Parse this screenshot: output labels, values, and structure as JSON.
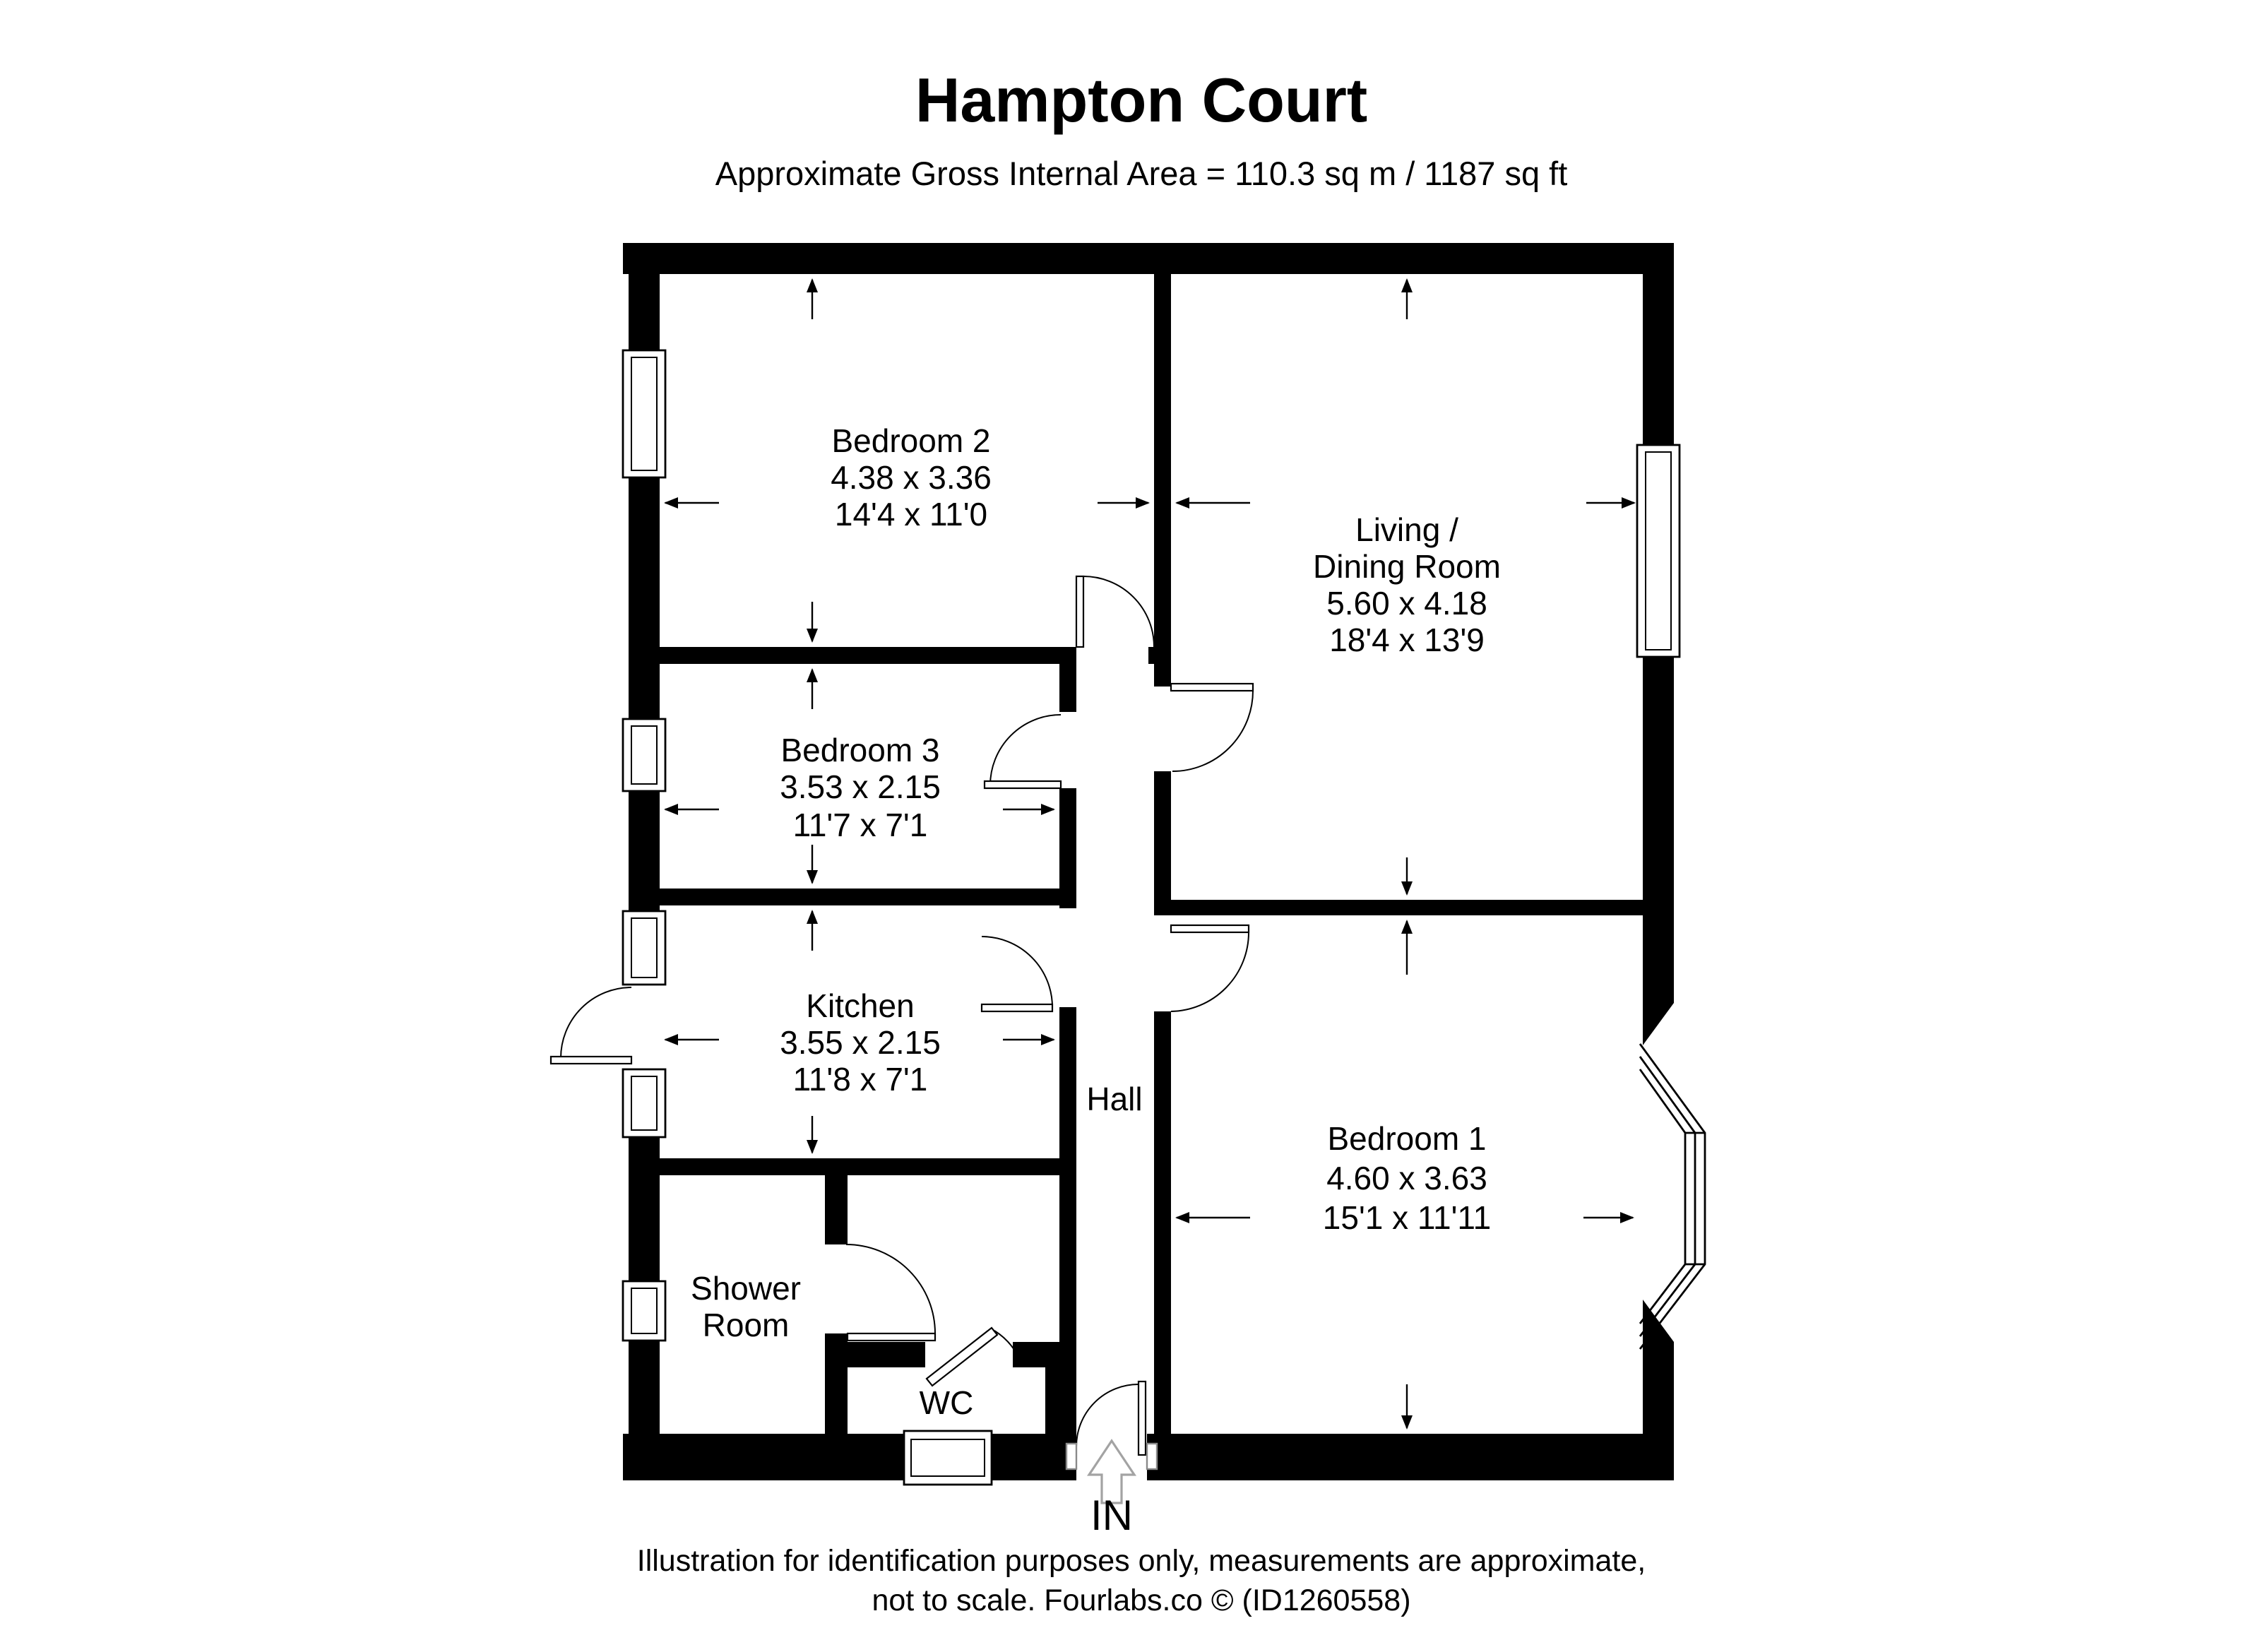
{
  "title": "Hampton Court",
  "subtitle": "Approximate Gross Internal Area = 110.3 sq m / 1187 sq ft",
  "rooms": {
    "bedroom2": {
      "name": "Bedroom 2",
      "metric": "4.38 x 3.36",
      "imperial": "14'4 x 11'0"
    },
    "living_dining": {
      "name_line1": "Living /",
      "name_line2": "Dining Room",
      "metric": "5.60 x 4.18",
      "imperial": "18'4 x 13'9"
    },
    "bedroom3": {
      "name": "Bedroom 3",
      "metric": "3.53 x 2.15",
      "imperial": "11'7 x 7'1"
    },
    "kitchen": {
      "name": "Kitchen",
      "metric": "3.55 x 2.15",
      "imperial": "11'8 x 7'1"
    },
    "hall": {
      "name": "Hall"
    },
    "bedroom1": {
      "name": "Bedroom 1",
      "metric": "4.60 x 3.63",
      "imperial": "15'1 x 11'11"
    },
    "shower_room": {
      "name_line1": "Shower",
      "name_line2": "Room"
    },
    "wc": {
      "name": "WC"
    }
  },
  "entrance": {
    "label": "IN"
  },
  "footer": {
    "line1": "Illustration for identification purposes only, measurements are approximate,",
    "line2": "not to scale. Fourlabs.co © (ID1260558)"
  },
  "colors": {
    "wall": "#000000",
    "background": "#ffffff",
    "dimension_arrow": "#000000",
    "entrance_arrow_outline": "#a3a3a3"
  }
}
